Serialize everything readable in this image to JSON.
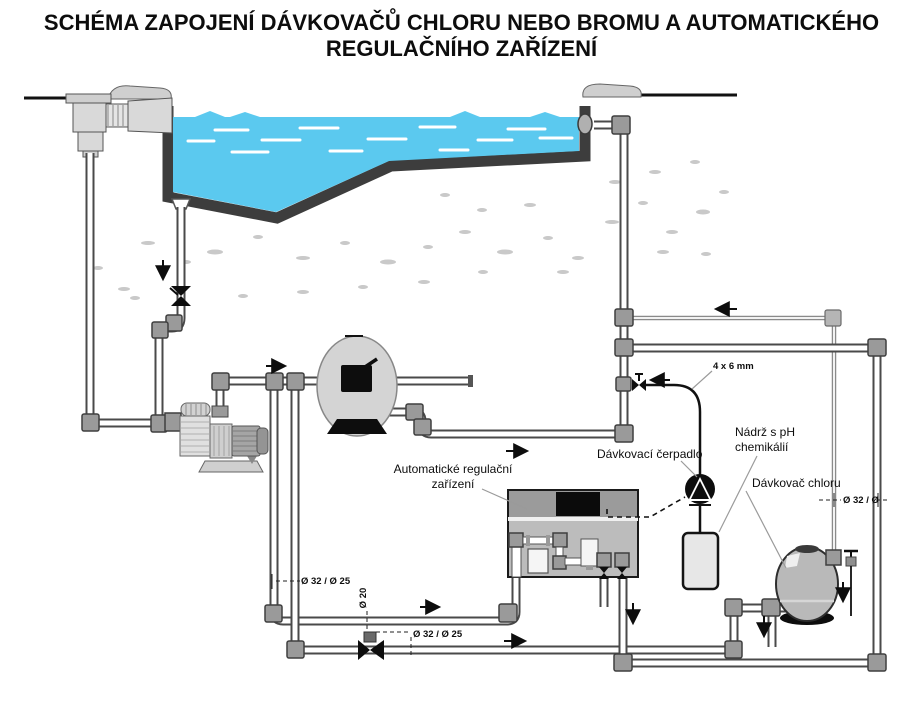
{
  "title": {
    "line1": "SCHÉMA ZAPOJENÍ DÁVKOVAČŮ CHLORU NEBO BROMU A AUTOMATICKÉHO",
    "line2": "REGULAČNÍHO ZAŘÍZENÍ"
  },
  "labels": {
    "tube_size": "4 x 6 mm",
    "dosing_pump": "Dávkovací čerpadlo",
    "ph_tank_line1": "Nádrž s pH",
    "ph_tank_line2": "chemikálií",
    "chlorine_doser": "Dávkovač chloru",
    "control_unit_line1": "Automatické regulační",
    "control_unit_line2": "zařízení"
  },
  "dimensions": {
    "riser_pipes": "Ø 32 / Ø 25",
    "bypass_valve": "Ø 20",
    "bottom_pipe": "Ø 32 / Ø 25",
    "right_pipe": "Ø 32 / Ø"
  },
  "colors": {
    "water": "#5bc9ef",
    "pool_wall": "#3d3d3d",
    "pipe_outline": "#4a4a4a",
    "fitting_gray": "#9a9a9a",
    "equipment_gray": "#d4d4d4",
    "doser_gray": "#b9b9b9",
    "control_unit_gray": "#bcbcbc",
    "ink": "#0d0d0d"
  }
}
